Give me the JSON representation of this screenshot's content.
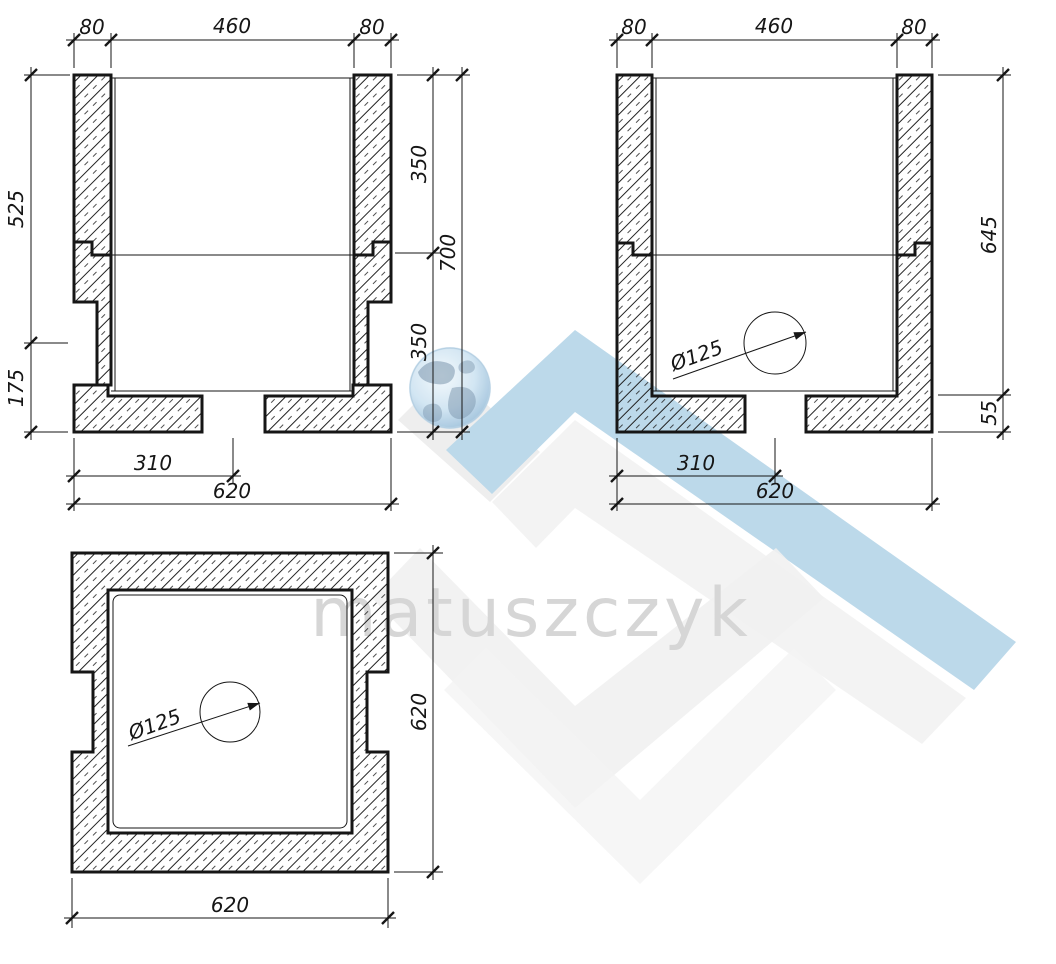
{
  "drawing": {
    "section_left": {
      "dim_top_left_wall": "80",
      "dim_top_opening": "460",
      "dim_top_right_wall": "80",
      "dim_left_upper": "525",
      "dim_left_lower": "175",
      "dim_right_upper": "350",
      "dim_right_lower": "350",
      "dim_right_total": "700",
      "dim_bottom_to_center": "310",
      "dim_bottom_total": "620"
    },
    "section_right": {
      "dim_top_left_wall": "80",
      "dim_top_opening": "460",
      "dim_top_right_wall": "80",
      "dim_right_upper": "645",
      "dim_right_lower": "55",
      "hole_diameter": "Ø125",
      "dim_bottom_to_center": "310",
      "dim_bottom_total": "620"
    },
    "plan": {
      "hole_diameter": "Ø125",
      "dim_right": "620",
      "dim_bottom": "620"
    }
  },
  "watermark": {
    "brand": "matuszczyk"
  },
  "colors": {
    "line": "#161616",
    "watermark_blue": "#b7d6e9",
    "watermark_gray": "#ededed",
    "watermark_gray_light": "#f3f3f3",
    "watermark_text": "#d3d3d3",
    "background": "#ffffff"
  }
}
